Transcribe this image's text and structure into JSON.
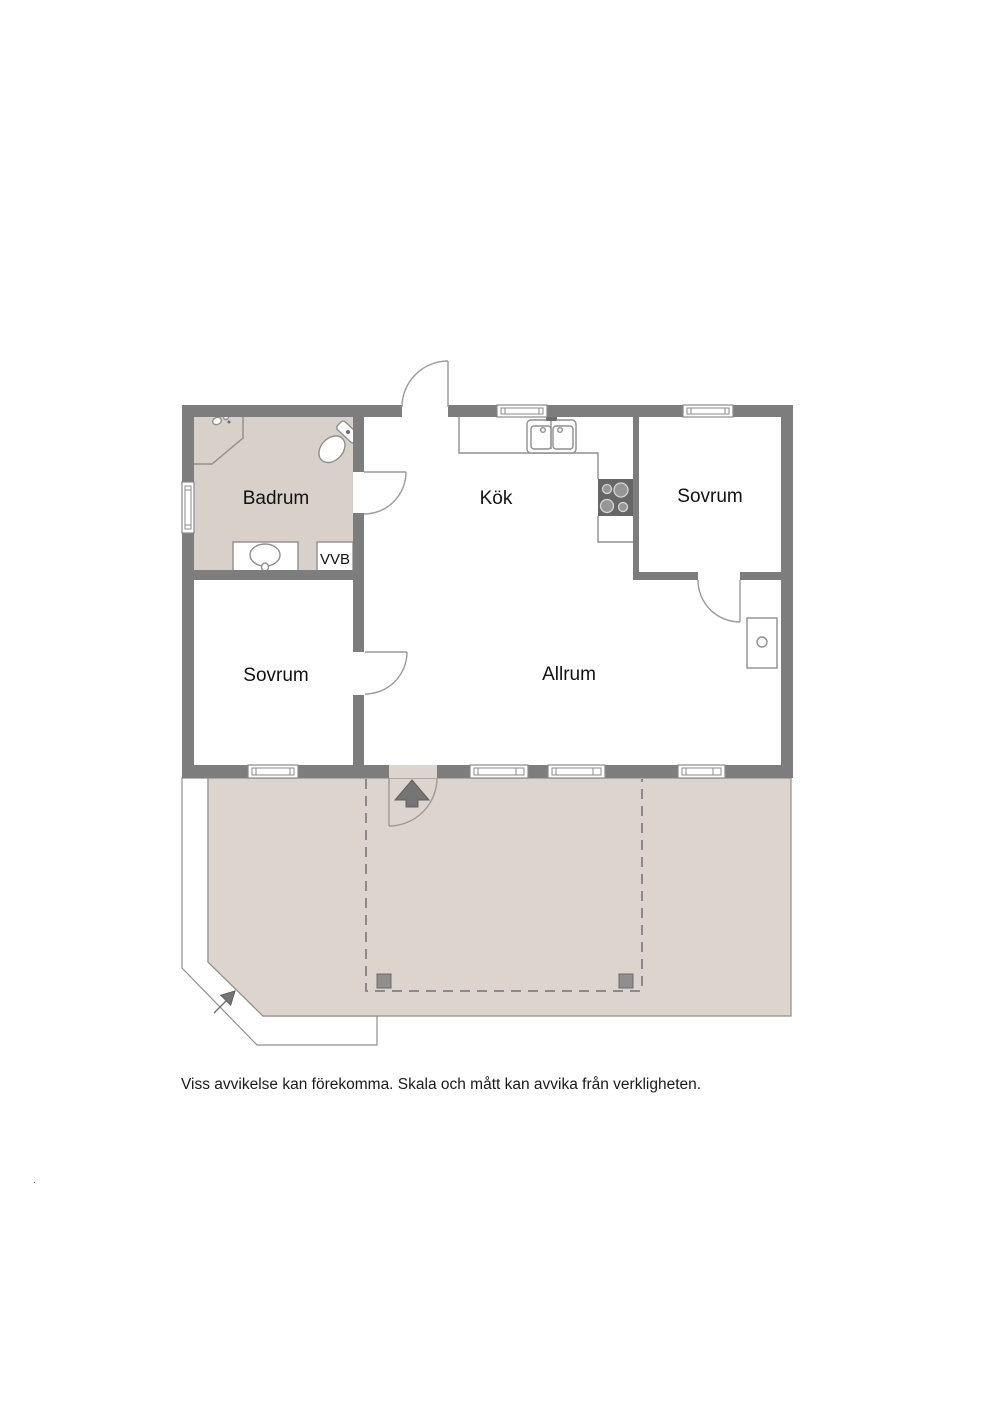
{
  "floorplan": {
    "rooms": [
      {
        "id": "badrum",
        "label": "Badrum"
      },
      {
        "id": "kok",
        "label": "Kök"
      },
      {
        "id": "sovrum-right",
        "label": "Sovrum"
      },
      {
        "id": "sovrum-left",
        "label": "Sovrum"
      },
      {
        "id": "allrum",
        "label": "Allrum"
      },
      {
        "id": "vvb",
        "label": "VVB"
      }
    ],
    "caption": "Viss avvikelse kan förekomma. Skala och mått kan avvika från verkligheten.",
    "stray_mark": ".",
    "colors": {
      "wall": "#7d7d7d",
      "line": "#8f8f8f",
      "bathroom_floor": "#d8d1c9",
      "terrace_floor": "#ddd5cd",
      "room_floor": "#ffffff",
      "stove": "#666666",
      "arrow": "#757575"
    }
  }
}
